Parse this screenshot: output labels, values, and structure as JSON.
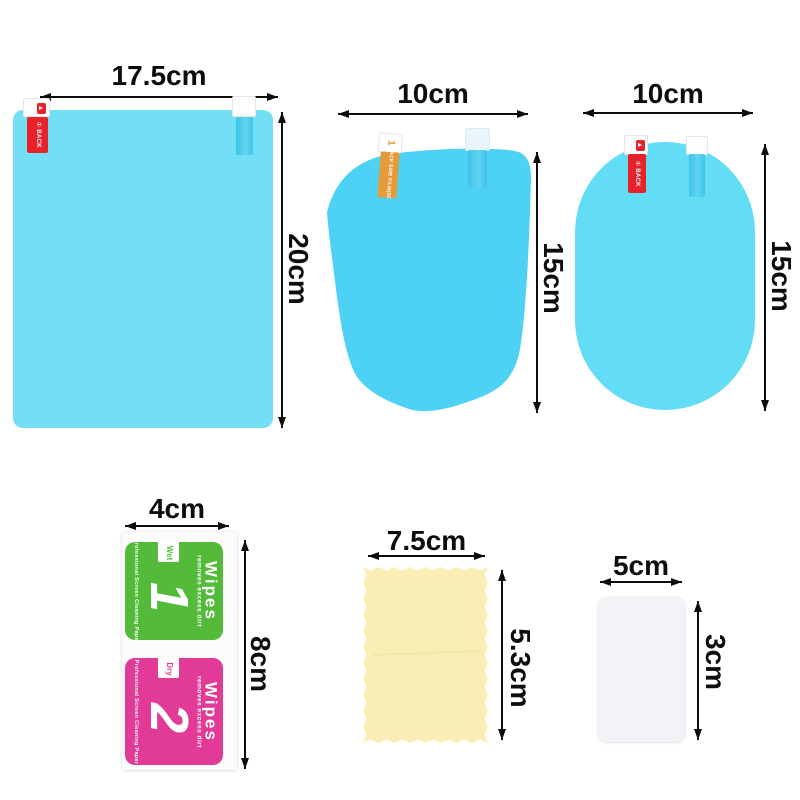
{
  "colors": {
    "film_large": "#73dff4",
    "film_mirror": "#4dd1f4",
    "film_oval": "#63dcf6",
    "tab_blue": "#3cc5ea",
    "tab_red": "#e7222b",
    "tab_orange": "#e49b3c",
    "wipe_green": "#54bb3a",
    "wipe_pink": "#e23a97",
    "cloth_yellow": "#faeeb5",
    "card_white": "#f3f2f7",
    "dim": "#0d0d0d"
  },
  "products": {
    "large_film": {
      "width_label": "17.5cm",
      "height_label": "20cm",
      "red_tab": {
        "number": "①",
        "text": "BACK"
      }
    },
    "mirror_film": {
      "width_label": "10cm",
      "height_label": "15cm",
      "orange_tab": {
        "number": "1",
        "text": "BACK SIDE FILM(SET"
      }
    },
    "oval_film": {
      "width_label": "10cm",
      "height_label": "15cm",
      "red_tab": {
        "number": "①",
        "text": "BACK"
      }
    },
    "wipes": {
      "width_label": "4cm",
      "height_label": "8cm",
      "packets": [
        {
          "brand": "Wipes",
          "tagline": "removes excess dirt",
          "number": "1",
          "type": "Wet",
          "edge_text": "Professional Screen Cleaning Paper"
        },
        {
          "brand": "Wipes",
          "tagline": "removes excess dirt",
          "number": "2",
          "type": "Dry",
          "edge_text": "Professional Screen Cleaning Paper"
        }
      ]
    },
    "cloth": {
      "width_label": "7.5cm",
      "height_label": "5.3cm"
    },
    "card": {
      "width_label": "5cm",
      "height_label": "3cm"
    }
  }
}
